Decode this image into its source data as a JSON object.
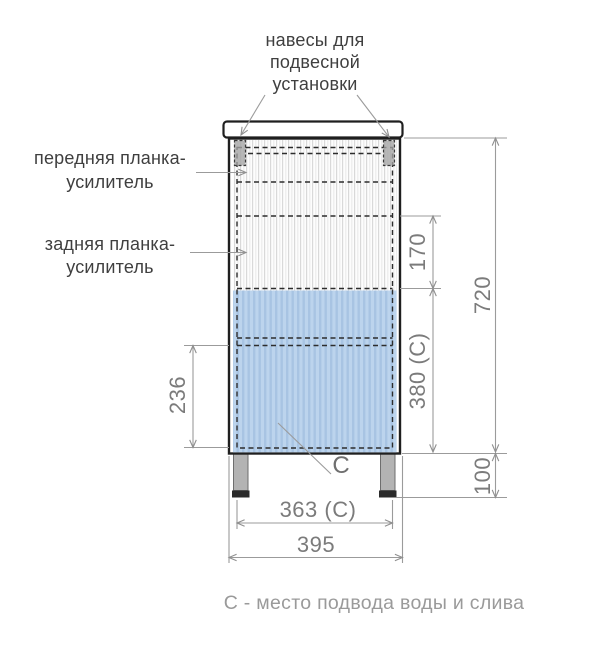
{
  "annotations": {
    "hangers_label": {
      "line1": "навесы для",
      "line2": "подвесной",
      "line3": "установки"
    },
    "front_bar_label": {
      "line1": "передняя планка-",
      "line2": "усилитель"
    },
    "rear_bar_label": {
      "line1": "задняя планка-",
      "line2": "усилитель"
    },
    "c_marker": "С",
    "caption": "С - место подвода воды и слива"
  },
  "dimensions": {
    "overall_height": "720",
    "upper_section": "170",
    "service_zone_height": "380 (С)",
    "lower_section": "236",
    "leg_height": "100",
    "service_zone_width": "363 (С)",
    "overall_width": "395"
  },
  "colors": {
    "service_zone_blue": "#aecbe9",
    "drawing_line": "#1f1f1f",
    "dimension_gray": "#7b7b7b",
    "caption_gray": "#9a9a9a"
  }
}
